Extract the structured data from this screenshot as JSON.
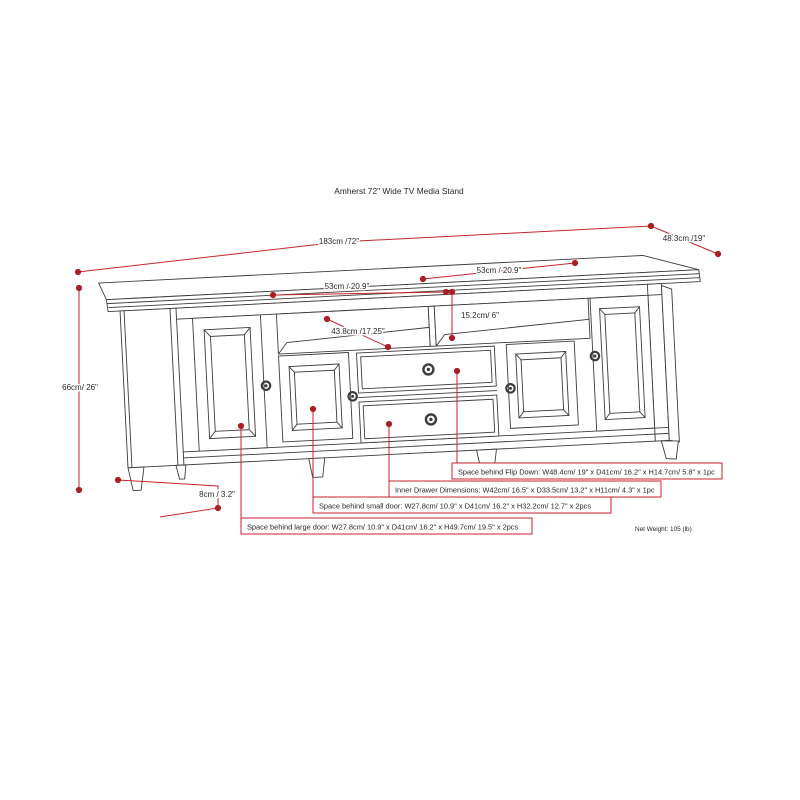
{
  "title": "Amherst 72\" Wide TV Media Stand",
  "dimensions": {
    "overall_width": "183cm /72\"",
    "overall_depth": "48.3cm /19\"",
    "overall_height": "66cm/ 26\"",
    "shelf_width_left": "53cm / 20.9\"",
    "shelf_width_right": "53cm / 20.9\"",
    "shelf_opening_height": "15.2cm/ 6\"",
    "shelf_depth": "43.8cm /17.25\"",
    "leg_height": "8cm / 3.2\""
  },
  "annotations": {
    "flip_down": "Space behind Flip Down: W48.4cm/ 19\" x D41cm/ 16.2\" x H14.7cm/ 5.8\" x 1pc",
    "inner_drawer": "Inner Drawer Dimensions: W42cm/ 16.5\" x D33.5cm/ 13.2\" x H11cm/ 4.3\" x 1pc",
    "small_door": "Space behind small door: W27.8cm/ 10.9\" x D41cm/ 16.2\" x H32.2cm/ 12.7\" x 2pcs",
    "large_door": "Space behind large door: W27.8cm/ 10.9\" x D41cm/ 16.2\" x H49.7cm/ 19.5\" x 2pcs"
  },
  "net_weight": "Net Weight: 105 (lb)",
  "colors": {
    "dimension_red": "#c5262c",
    "dot_red": "#ab1f24",
    "line_gray": "#3c3c3c"
  }
}
